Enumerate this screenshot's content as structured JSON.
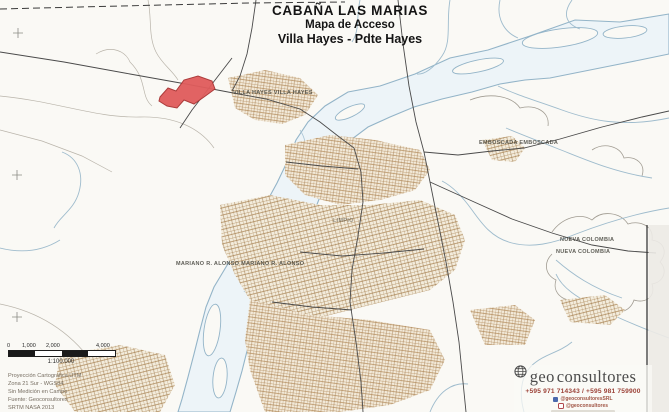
{
  "title": {
    "line1": "CABAÑA LAS MARIAS",
    "line2": "Mapa de Acceso",
    "line3": "Villa Hayes - Pdte Hayes"
  },
  "map_labels": {
    "villa_hayes": "VILLA HAYES VILLA HAYES",
    "emboscada": "EMBOSCADA EMBOSCADA",
    "nueva_colombia_1": "NUEVA COLOMBIA",
    "nueva_colombia_2": "NUEVA COLOMBIA",
    "mariano_r_alonso": "MARIANO R. ALONSO MARIANO R. ALONSO",
    "limpio": "LIMPIO"
  },
  "scale_bar": {
    "ticks": [
      "0",
      "1,000",
      "2,000",
      "4,000"
    ],
    "ratio": "1:100.000"
  },
  "credits": {
    "line1": "Proyección Cartográfica UTM",
    "line2": "Zona 21 Sur - WGS84",
    "line3": "Sin Medición en Campo",
    "line4": "Fuente: Geoconsultores",
    "line5": "SRTM NASA 2013"
  },
  "logo": {
    "name_prefix": "geo",
    "name_suffix": "consultores",
    "phone": "+595 971 714343 / +595 981 759900",
    "social1": "@geoconsultoresSRL",
    "social2": "@geoconsultores"
  },
  "colors": {
    "parcel_fill": "#e05c5c",
    "parcel_stroke": "#a83232",
    "river_stroke": "#93b4c8",
    "river_fill": "#edf4f8",
    "urban": "#b68f5e",
    "road": "#4a4a4a"
  }
}
